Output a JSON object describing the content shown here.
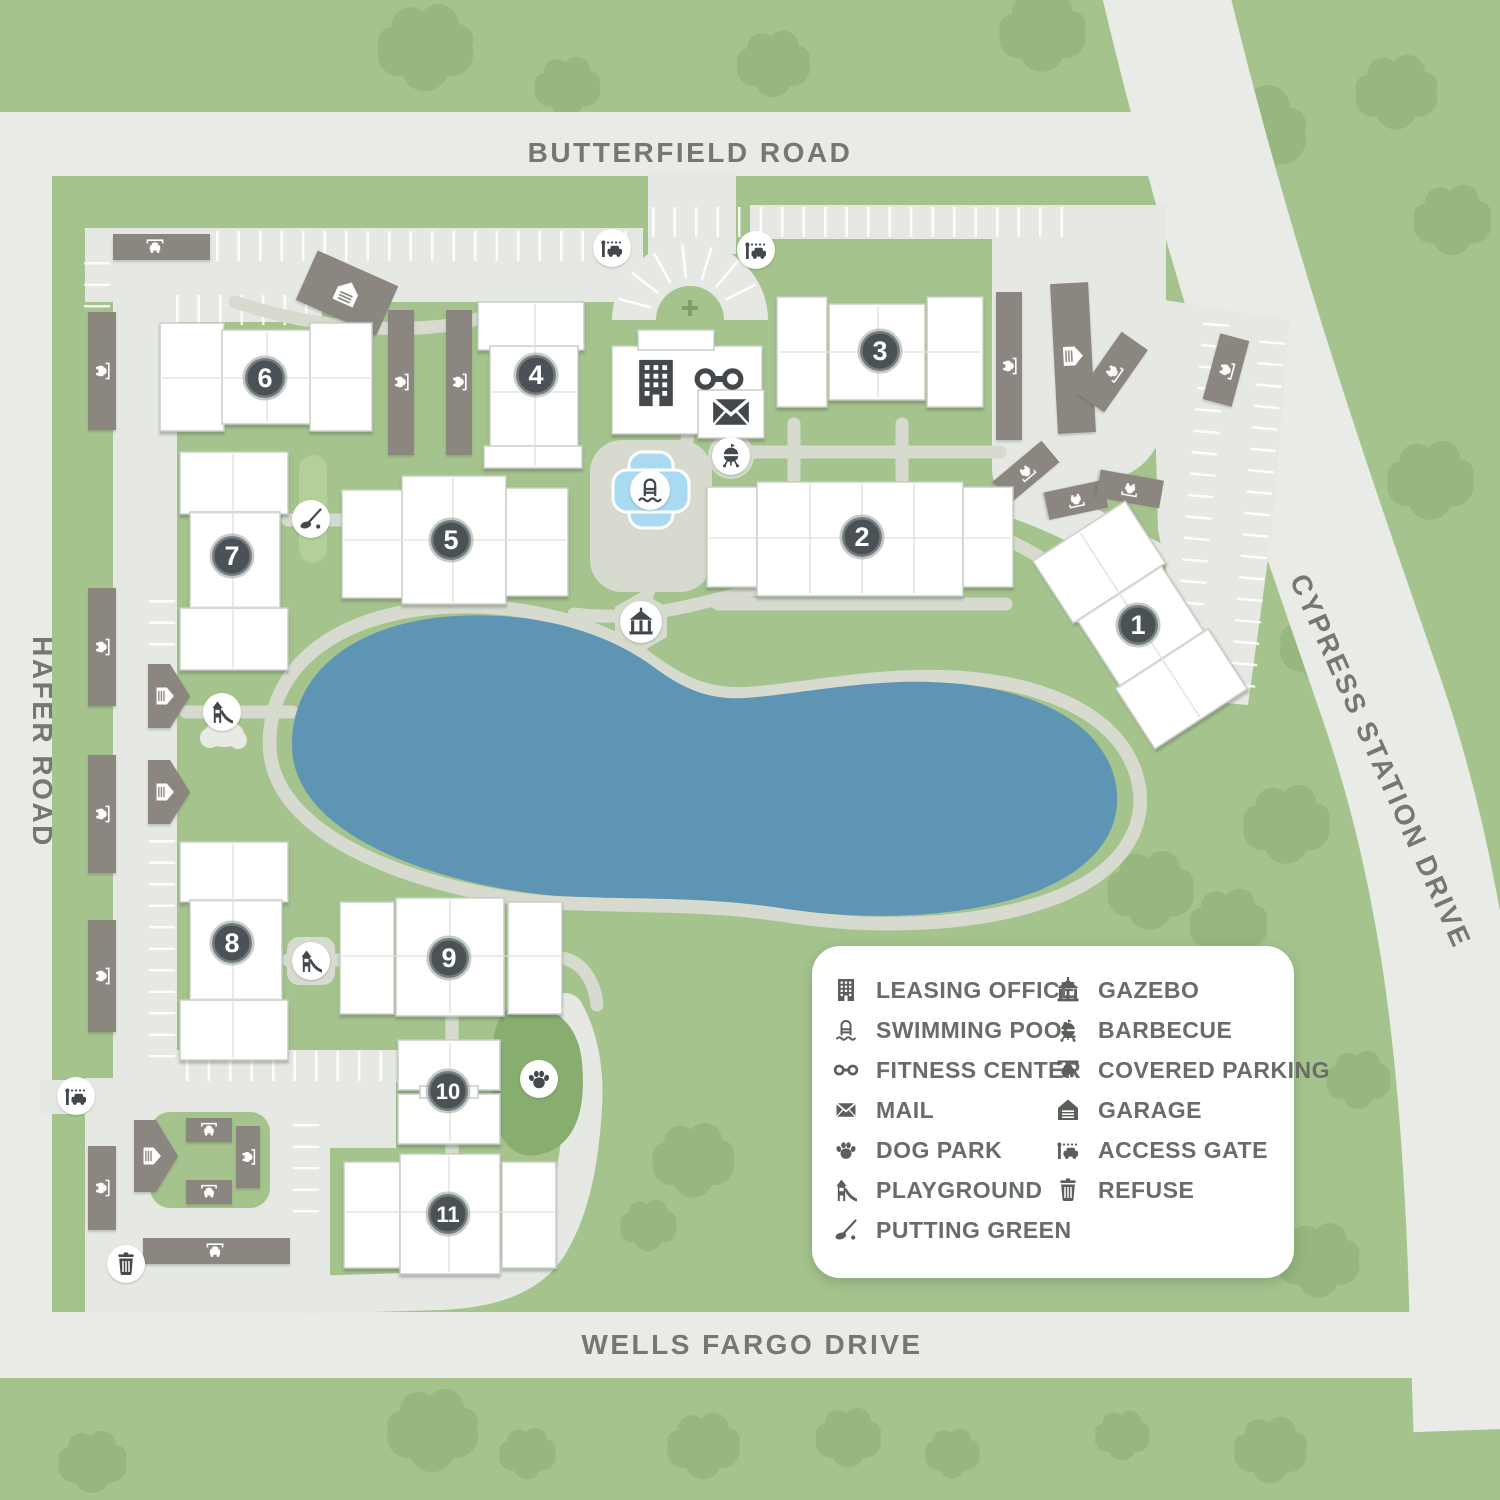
{
  "map": {
    "roads": {
      "top": "BUTTERFIELD ROAD",
      "left": "HAFER ROAD",
      "right": "CYPRESS STATION DRIVE",
      "bottom": "WELLS FARGO DRIVE"
    },
    "buildings": [
      {
        "number": "1"
      },
      {
        "number": "2"
      },
      {
        "number": "3"
      },
      {
        "number": "4"
      },
      {
        "number": "5"
      },
      {
        "number": "6"
      },
      {
        "number": "7"
      },
      {
        "number": "8"
      },
      {
        "number": "9"
      },
      {
        "number": "10"
      },
      {
        "number": "11"
      }
    ],
    "amenity_markers": [
      "leasing-office",
      "fitness-center",
      "mail",
      "swimming-pool",
      "barbecue",
      "gazebo",
      "putting-green",
      "playground",
      "playground",
      "dog-park",
      "access-gate",
      "access-gate",
      "access-gate",
      "refuse"
    ],
    "colors": {
      "grass": "#a5c38c",
      "tree": "#96b77d",
      "road": "#e9ebe7",
      "path": "#d6dacf",
      "lake": "#5e95b5",
      "pool": "#a9daf2",
      "structure": "#8b8680",
      "building": "#ffffff",
      "badge": "#4b5257",
      "icon": "#42484c",
      "label": "#74786e",
      "dog_park": "#87ae6f",
      "putting_green": "#b4cf99"
    }
  },
  "legend": {
    "left": [
      {
        "icon": "leasing-office-icon",
        "label": "LEASING OFFICE"
      },
      {
        "icon": "swimming-pool-icon",
        "label": "SWIMMING POOL"
      },
      {
        "icon": "fitness-center-icon",
        "label": "FITNESS CENTER"
      },
      {
        "icon": "mail-icon",
        "label": "MAIL"
      },
      {
        "icon": "dog-park-icon",
        "label": "DOG PARK"
      },
      {
        "icon": "playground-icon",
        "label": "PLAYGROUND"
      },
      {
        "icon": "putting-green-icon",
        "label": "PUTTING GREEN"
      }
    ],
    "right": [
      {
        "icon": "gazebo-icon",
        "label": "GAZEBO"
      },
      {
        "icon": "barbecue-icon",
        "label": "BARBECUE"
      },
      {
        "icon": "covered-parking-icon",
        "label": "COVERED PARKING"
      },
      {
        "icon": "garage-icon",
        "label": "GARAGE"
      },
      {
        "icon": "access-gate-icon",
        "label": "ACCESS GATE"
      },
      {
        "icon": "refuse-icon",
        "label": "REFUSE"
      }
    ]
  }
}
